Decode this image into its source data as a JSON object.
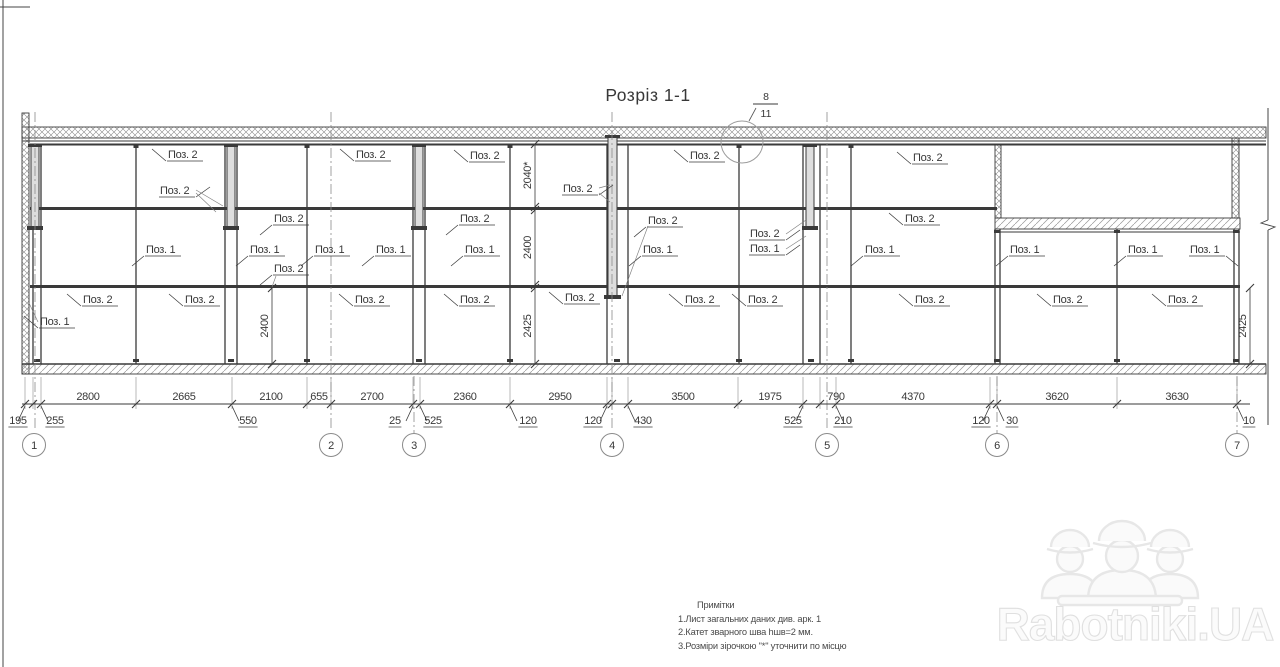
{
  "title": "Розріз 1-1",
  "detail_callout": {
    "top": "8",
    "bottom": "11"
  },
  "axes": [
    "1",
    "2",
    "3",
    "4",
    "5",
    "6",
    "7"
  ],
  "dims": {
    "top_row": [
      "2800",
      "2665",
      "2100",
      "655",
      "2700",
      "2360",
      "2950",
      "3500",
      "1975",
      "790",
      "4370",
      "3620",
      "3630"
    ],
    "sub_row": [
      "195",
      "255",
      "550",
      "25",
      "525",
      "120",
      "120",
      "430",
      "525",
      "210",
      "120",
      "30",
      "10"
    ],
    "vertical": [
      "2040*",
      "2400",
      "2425",
      "2400",
      "2425"
    ]
  },
  "pos_labels": [
    "Поз. 2",
    "Поз. 2",
    "Поз. 2",
    "Поз. 2",
    "Поз. 2",
    "Поз. 2",
    "Поз. 2",
    "Поз. 2",
    "Поз. 2",
    "Поз. 2",
    "Поз. 2",
    "Поз. 2",
    "Поз. 1",
    "Поз. 1",
    "Поз. 1",
    "Поз. 1",
    "Поз. 1",
    "Поз. 1",
    "Поз. 1",
    "Поз. 1",
    "Поз. 1",
    "Поз. 1",
    "Поз. 1",
    "Поз. 2",
    "Поз. 2",
    "Поз. 2",
    "Поз. 2",
    "Поз. 2",
    "Поз. 2",
    "Поз. 2",
    "Поз. 2",
    "Поз. 2",
    "Поз. 2",
    "Поз. 2",
    "Поз. 1"
  ],
  "notes": {
    "heading": "Примітки",
    "items": [
      "1.Лист загальних даних див. арк. 1",
      "2.Катет зварного шва  hшв=2 мм.",
      "3.Розміри зірочкою \"*\" уточнити по місцю"
    ]
  },
  "watermark": {
    "text": "Rabotniki.UA"
  },
  "colors": {
    "line": "#3a3a3a",
    "light_line": "#7f7f7f",
    "hatch": "#8a8a8a",
    "watermark": "#e5e5e5"
  }
}
